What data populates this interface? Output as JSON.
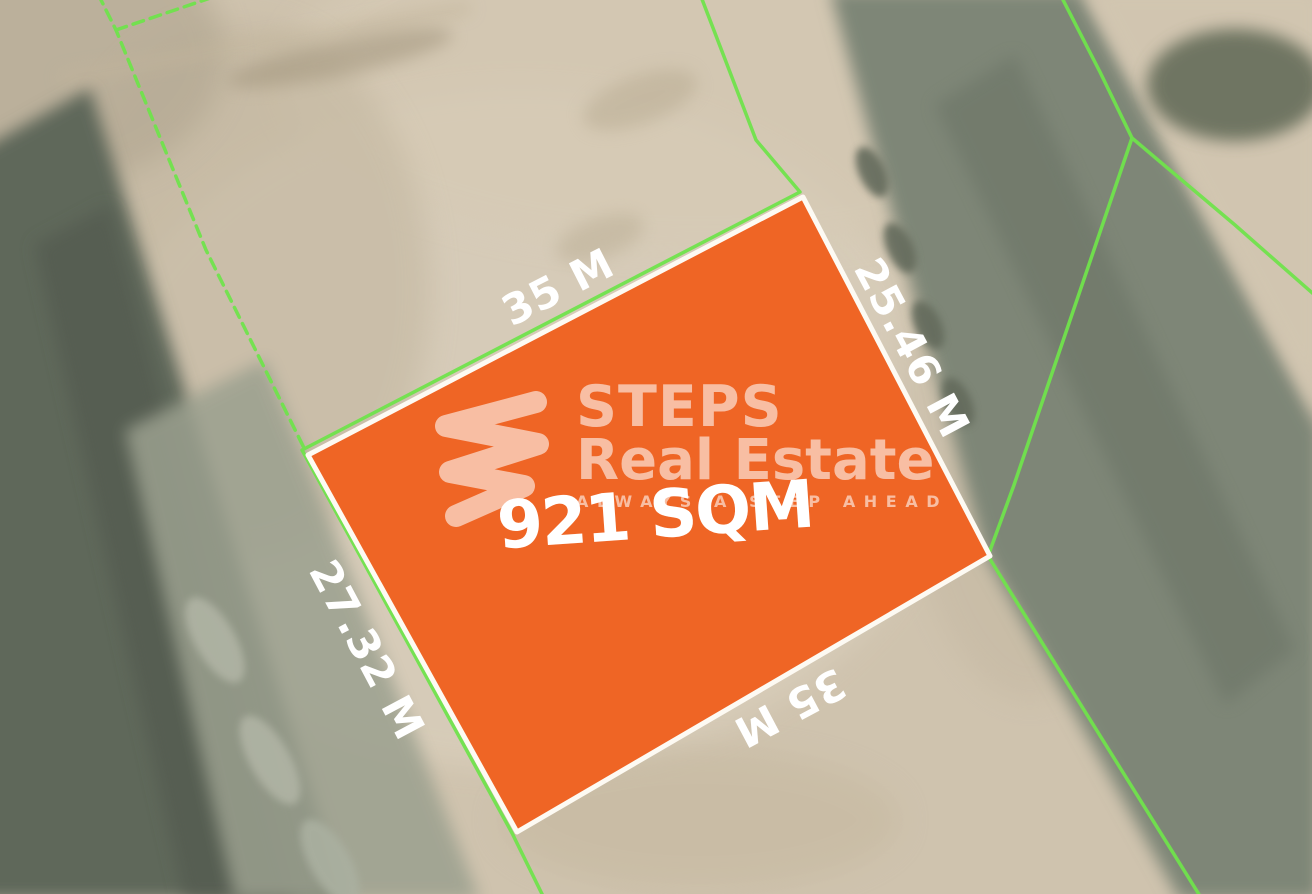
{
  "plot": {
    "area_label": "921 SQM",
    "dim_top": "35 M",
    "dim_right": "25.46 M",
    "dim_left": "27.32 M",
    "dim_bottom": "35 M"
  },
  "brand": {
    "name_line1": "STEPS",
    "name_line2": "Real Estate",
    "tagline": "ALWAYS A STEP AHEAD"
  },
  "colors": {
    "plot_fill": "#ef6525",
    "plot_border": "#fdfaf3",
    "boundary_line": "#70e34c",
    "dimension_text": "#ffffff",
    "area_text": "#ffffff",
    "sand_base": "#cfc3ae",
    "road_dark": "#5f675a",
    "road_right": "#7e8677"
  }
}
